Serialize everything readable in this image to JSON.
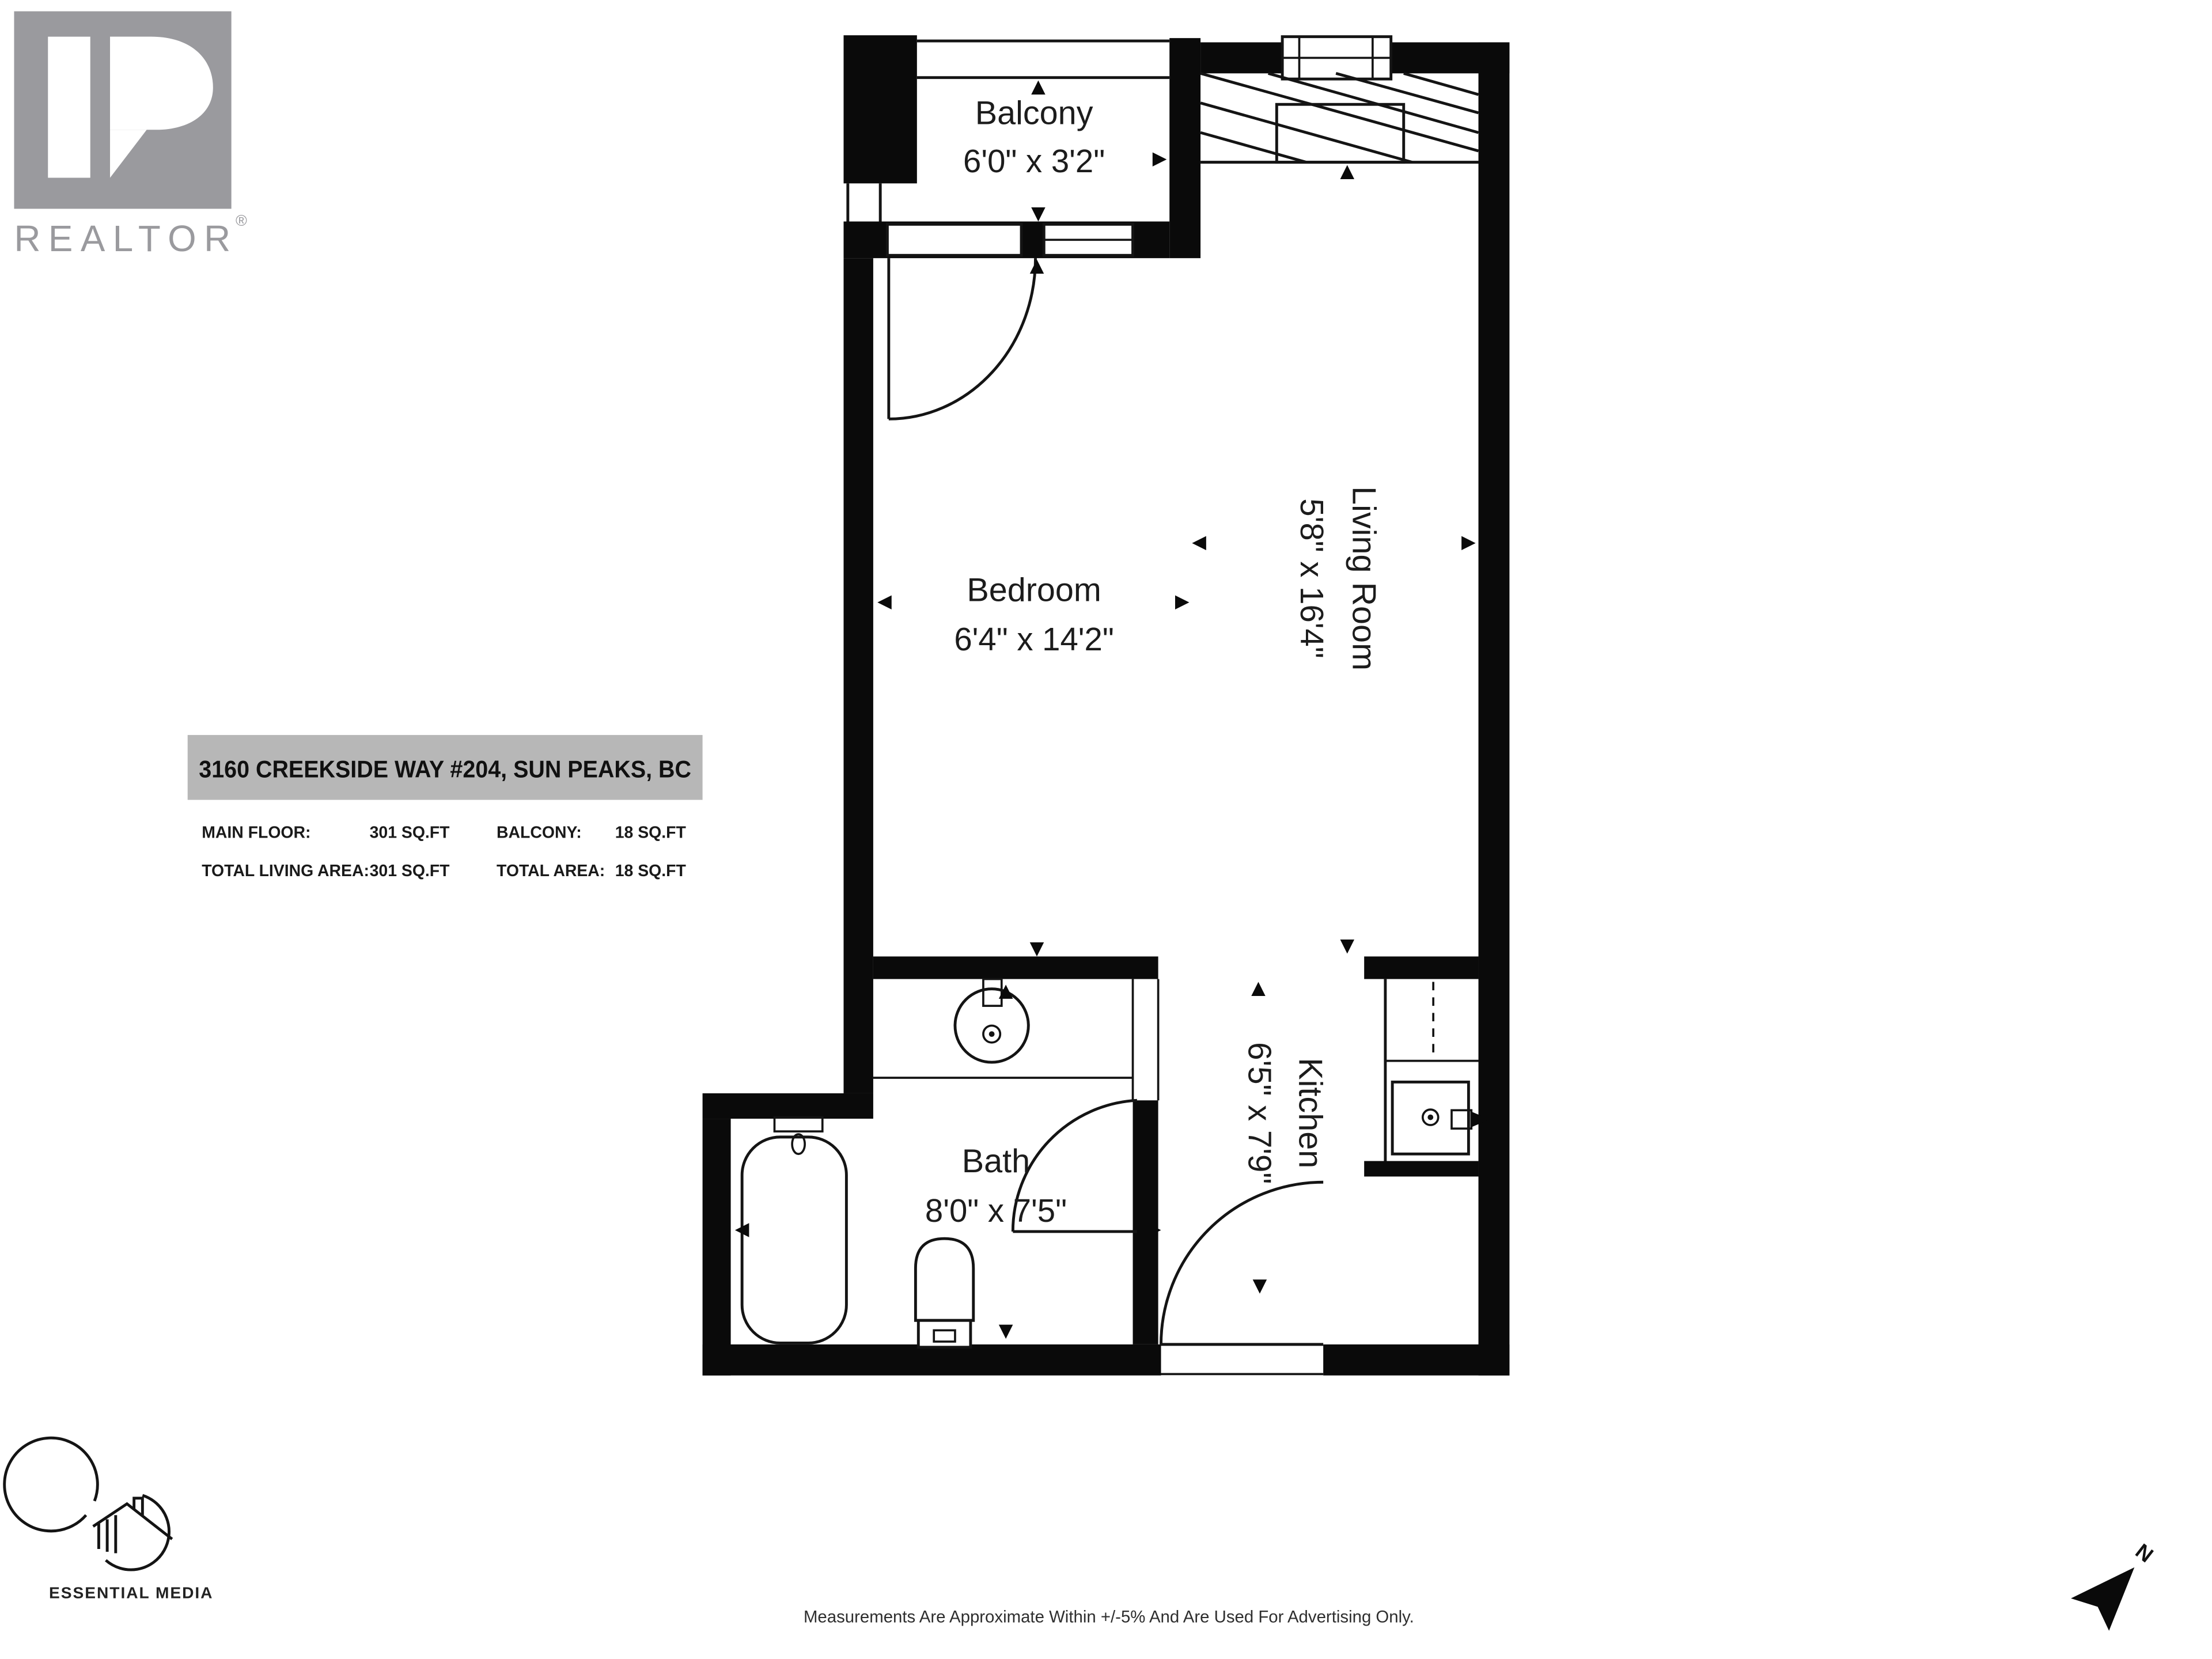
{
  "colors": {
    "wall": "#0a0a0a",
    "banner_bg": "#b7b7b7",
    "logo_gray": "#9a9a9e",
    "text": "#1c1c1c"
  },
  "branding": {
    "realtor_wordmark": "REALTOR",
    "registered_symbol": "®",
    "media_credit": "ESSENTIAL MEDIA"
  },
  "address_card": {
    "address": "3160 CREEKSIDE WAY #204, SUN PEAKS, BC",
    "stats": [
      {
        "label": "MAIN FLOOR:",
        "value": "301 SQ.FT"
      },
      {
        "label": "BALCONY:",
        "value": "18 SQ.FT"
      },
      {
        "label": "TOTAL LIVING AREA:",
        "value": "301 SQ.FT"
      },
      {
        "label": "TOTAL AREA:",
        "value": "18 SQ.FT"
      }
    ]
  },
  "rooms": {
    "balcony": {
      "name": "Balcony",
      "dimensions": "6'0\" x 3'2\""
    },
    "bedroom": {
      "name": "Bedroom",
      "dimensions": "6'4\" x 14'2\""
    },
    "living_room": {
      "name": "Living Room",
      "dimensions": "5'8\" x 16'4\""
    },
    "bath": {
      "name": "Bath",
      "dimensions": "8'0\" x 7'5\""
    },
    "kitchen": {
      "name": "Kitchen",
      "dimensions": "6'5\" x 7'9\""
    }
  },
  "compass": {
    "north_label": "N"
  },
  "footer": {
    "disclaimer": "Measurements Are Approximate Within +/-5% And Are Used For Advertising Only."
  }
}
